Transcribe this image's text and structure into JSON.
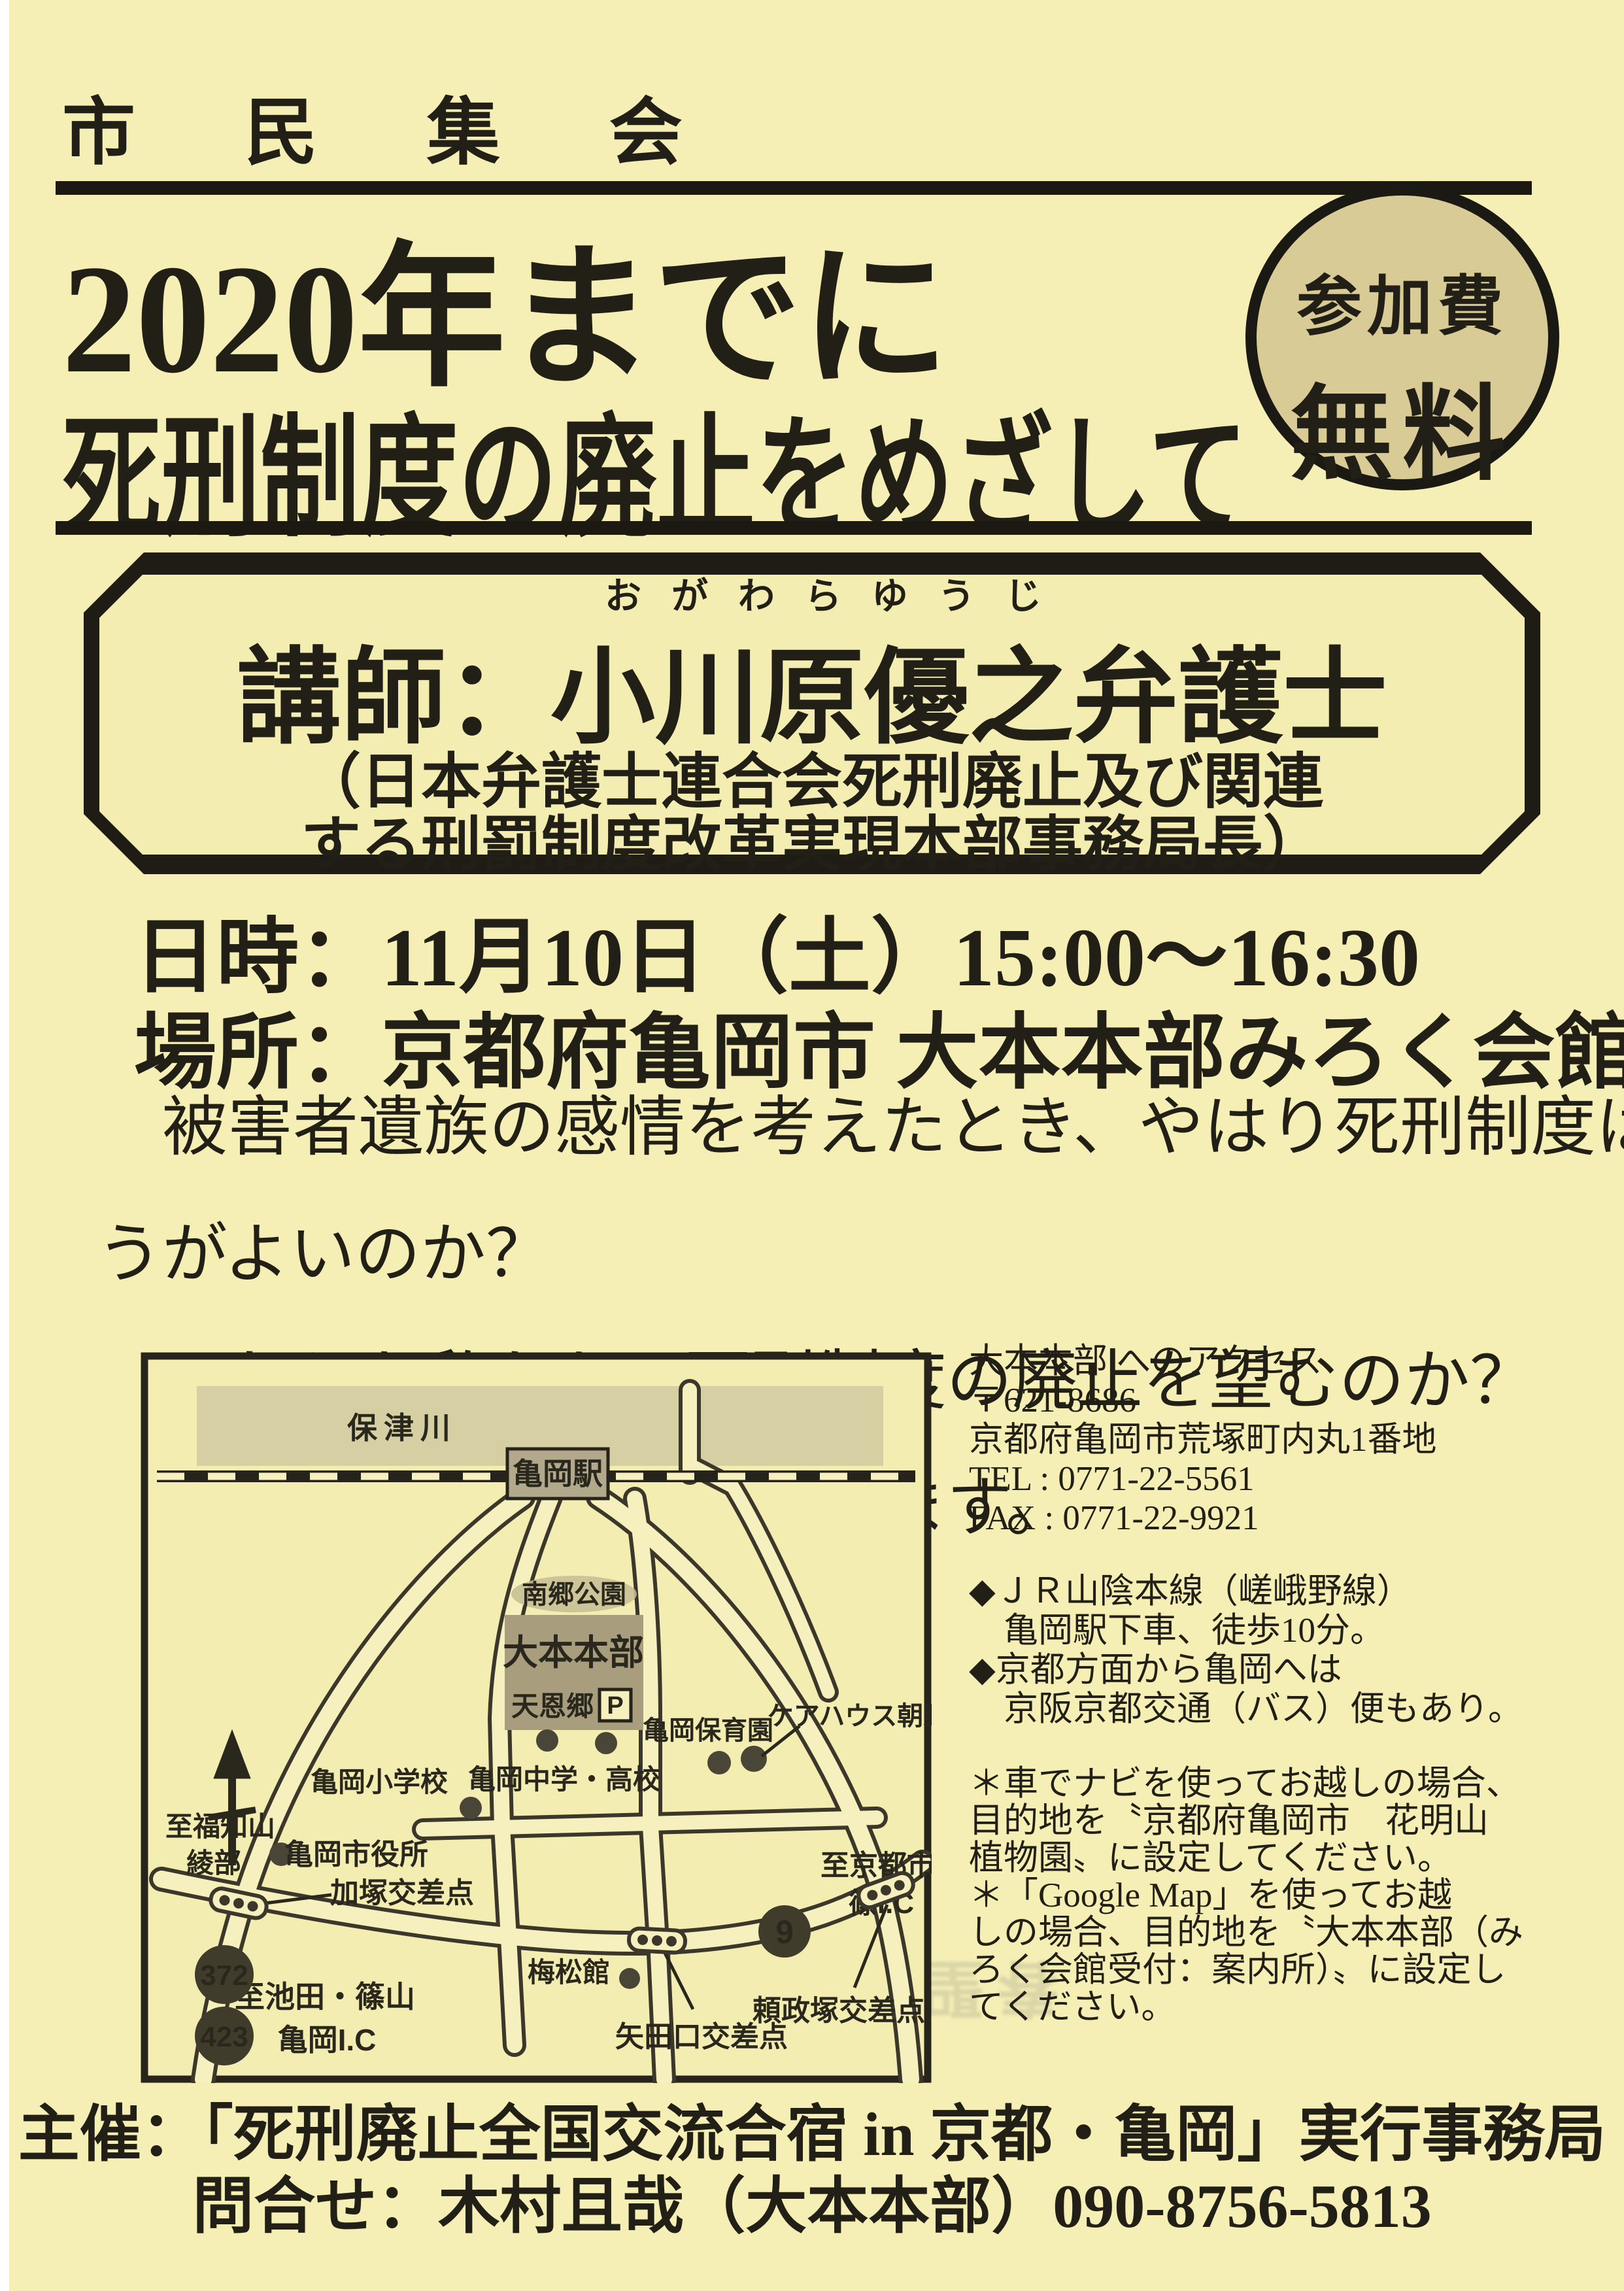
{
  "page": {
    "background": "#f5eeb5",
    "ink": "#211f16",
    "accent_badge_bg": "#d8cb96"
  },
  "header": {
    "kicker": "市 民 集 会",
    "title_line1": "2020年までに",
    "title_line2": "死刑制度の廃止をめざして"
  },
  "fee_badge": {
    "line1": "参加費",
    "line2": "無料"
  },
  "speaker_box": {
    "furigana": "おがわらゆうじ",
    "name_line": "講師：小川原優之弁護士",
    "affiliation_line1": "（日本弁護士連合会死刑廃止及び関連",
    "affiliation_line2": "する刑罰制度改革実現本部事務局長）"
  },
  "event": {
    "datetime_line": "日時：11月10日（土）15:00～16:30",
    "venue_line": "場所：京都府亀岡市 大本本部みろく会館"
  },
  "body_paragraph": {
    "line1": "　被害者遺族の感情を考えたとき、やはり死刑制度はあったほ",
    "line2": "うがよいのか？",
    "line3": "　それとも私たちは死刑制度の廃止を望むのか？",
    "line4": "　皆さんと考えたいと思います。"
  },
  "access": {
    "heading": "大本本部 へのアクセス",
    "postal": "〒621-8686",
    "address": "京都府亀岡市荒塚町内丸1番地",
    "tel": "TEL : 0771-22-5561",
    "fax": "FAX : 0771-22-9921",
    "transit": [
      "◆ＪＲ山陰本線（嵯峨野線）",
      "　亀岡駅下車、徒歩10分。",
      "◆京都方面から亀岡へは",
      "　京阪京都交通（バス）便もあり。"
    ],
    "car_note": [
      "＊車でナビを使ってお越しの場合、",
      "目的地を〝京都府亀岡市　花明山",
      "植物園〟に設定してください。",
      "＊「Google Map」を使ってお越",
      "しの場合、目的地を〝大本本部（み",
      "ろく会館受付：案内所）〟に設定し",
      "てください。"
    ]
  },
  "map": {
    "river": "保津川",
    "station": "亀岡駅",
    "park": "南郷公園",
    "headquarters": "大本本部",
    "tenonkyo": "天恩郷",
    "parking": "P",
    "elementary_school": "亀岡小学校",
    "junior_high": "亀岡中学・高校",
    "nursery": "亀岡保育園",
    "care_house": "ケアハウス朝野",
    "city_hall": "亀岡市役所",
    "kazuka_crossing": "加塚交差点",
    "baishokan": "梅松館",
    "yadaguchi_crossing": "矢田口交差点",
    "yorimasazuka_crossing": "頼政塚交差点",
    "to_fukuchiyama": "至福知山",
    "ayabe": "綾部",
    "to_kyoto_city": "至京都市",
    "shino_ic": "篠I.C",
    "to_ikeda_sasayama": "至池田・篠山",
    "kameoka_ic": "亀岡I.C",
    "route_372": "372",
    "route_423": "423",
    "route_9": "9"
  },
  "footer": {
    "organizer_line": "主催：「死刑廃止全国交流合宿 in 京都・亀岡」実行事務局",
    "contact_line": "問合せ：木村且哉（大本本部）090-8756-5813"
  },
  "artifacts": {
    "bleed1": "ゆ合き買会解懸・買",
    "bleed2": "（如日は）字扱斯曾",
    "bleed3": "春聖希　ぐらろ野"
  }
}
